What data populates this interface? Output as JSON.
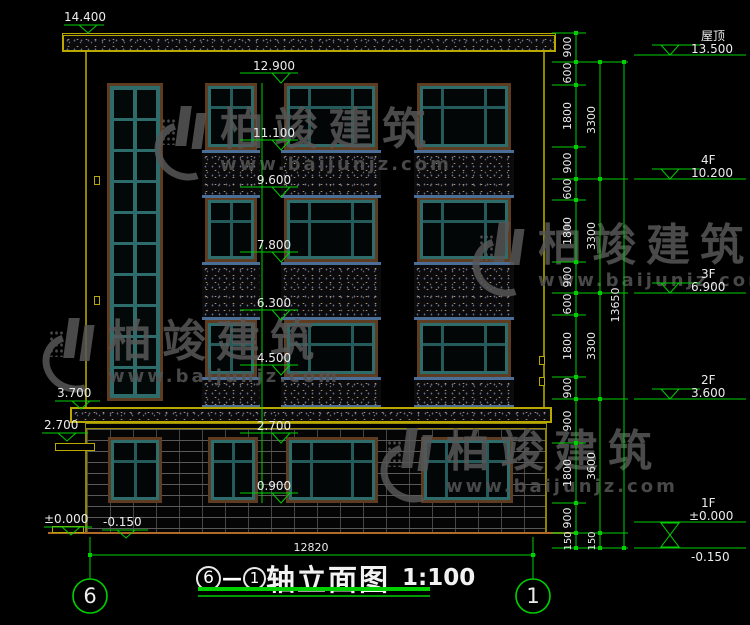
{
  "drawing": {
    "title": {
      "axis_left": "6",
      "separator": "—",
      "axis_right": "1",
      "label": "轴立面图",
      "scale": "1:100"
    },
    "axis_left": "6",
    "axis_right": "1"
  },
  "elevations": {
    "left": [
      "14.400",
      "3.700",
      "2.700",
      "±0.000",
      "-0.150"
    ],
    "center": [
      "12.900",
      "11.100",
      "9.600",
      "7.800",
      "6.300",
      "4.500",
      "2.700",
      "0.900"
    ],
    "right": [
      {
        "name": "屋顶",
        "value": "13.500"
      },
      {
        "name": "4F",
        "value": "10.200"
      },
      {
        "name": "3F",
        "value": "6.900"
      },
      {
        "name": "2F",
        "value": "3.600"
      },
      {
        "name": "1F",
        "value": "±0.000"
      },
      {
        "name": "",
        "value": "-0.150"
      }
    ]
  },
  "dimensions": {
    "inner_chain": [
      "900",
      "600",
      "1800",
      "900",
      "600",
      "1800",
      "900",
      "600",
      "1800",
      "900",
      "900",
      "1800",
      "900",
      "150"
    ],
    "floor_chain": [
      "3300",
      "3300",
      "3300",
      "3600",
      "150"
    ],
    "overall_height": "13650",
    "overall_width": "12820"
  },
  "watermark": {
    "brand": "柏竣建筑",
    "url": "www.baijunjz.com"
  },
  "colors": {
    "dimension_green": "#00cf00",
    "structure_yellow": "#b8a800",
    "ground_orange": "#b06a28",
    "window_teal": "#2e6b6b",
    "band_blue": "#4a6e96",
    "text_white": "#ececec"
  }
}
